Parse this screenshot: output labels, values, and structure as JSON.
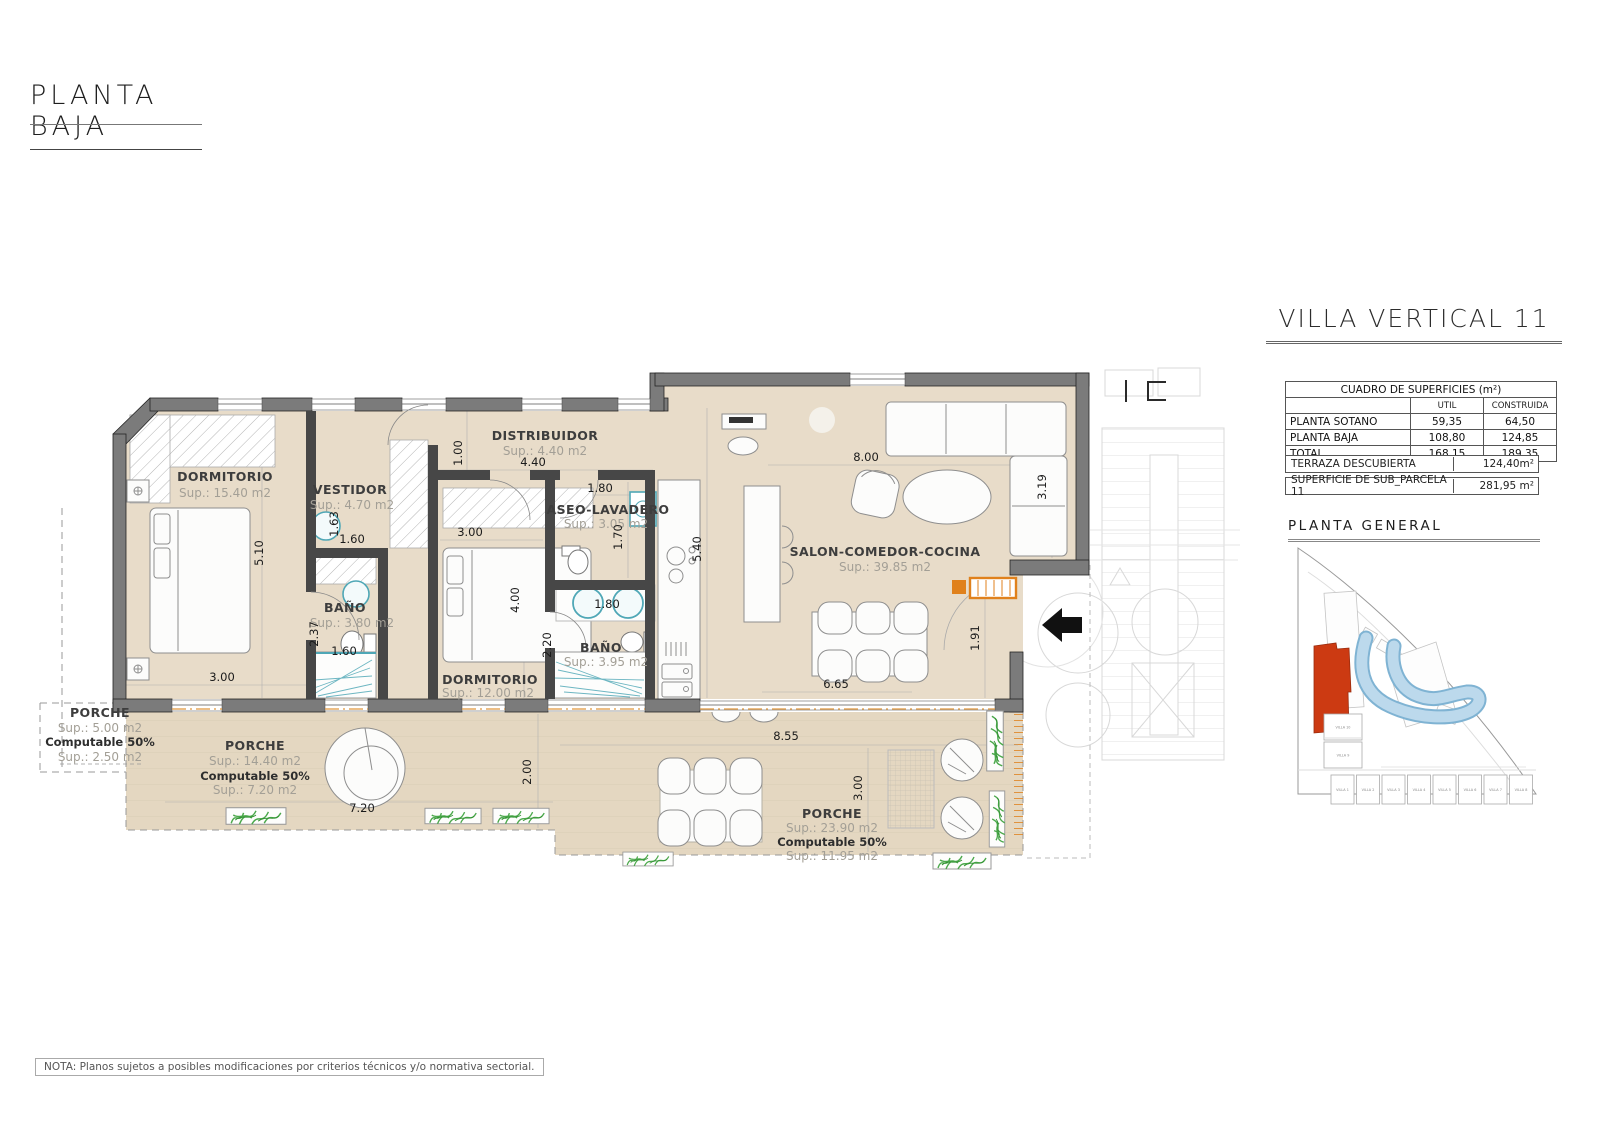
{
  "page": {
    "title": "PLANTA BAJA",
    "note": "NOTA: Planos sujetos a posibles modificaciones por criterios técnicos y/o normativa sectorial."
  },
  "panel": {
    "villa_title": "VILLA VERTICAL 11",
    "table": {
      "title": "CUADRO DE SUPERFICIES (m²)",
      "cols": [
        "UTIL",
        "CONSTRUIDA"
      ],
      "rows": [
        [
          "PLANTA SOTANO",
          "59,35",
          "64,50"
        ],
        [
          "PLANTA BAJA",
          "108,80",
          "124,85"
        ],
        [
          "TOTAL",
          "168,15",
          "189,35"
        ]
      ]
    },
    "terraza_label": "TERRAZA DESCUBIERTA",
    "terraza_value": "124,40m²",
    "parcela_label": "SUPERFICIE DE SUB_PARCELA 11",
    "parcela_value": "281,95 m²",
    "siteplan_title": "PLANTA GENERAL",
    "site_villas_row": [
      "VILLA 1",
      "VILLA 2",
      "VILLA 3",
      "VILLA 4",
      "VILLA 5",
      "VILLA 6",
      "VILLA 7",
      "VILLA 8"
    ],
    "site_villas_left": [
      "VILLA 10",
      "VILLA 9"
    ]
  },
  "floorplan": {
    "rooms": {
      "dormitorio1": {
        "name": "DORMITORIO",
        "sup": "Sup.: 15.40  m2"
      },
      "vestidor": {
        "name": "VESTIDOR",
        "sup": "Sup.: 4.70    m2"
      },
      "bano1": {
        "name": "BAÑO",
        "sup": "Sup.: 3.80    m2"
      },
      "distribuidor": {
        "name": "DISTRIBUIDOR",
        "sup": "Sup.: 4.40    m2"
      },
      "aseo": {
        "name": "ASEO-LAVADERO",
        "sup": "Sup.: 3.05   m2"
      },
      "bano2": {
        "name": "BAÑO",
        "sup": "Sup.: 3.95    m2"
      },
      "dormitorio2": {
        "name": "DORMITORIO",
        "sup": "Sup.: 12.00  m2"
      },
      "salon": {
        "name": "SALON-COMEDOR-COCINA",
        "sup": "Sup.: 39.85 m2"
      },
      "porche_left": {
        "name": "PORCHE",
        "sup": "Sup.: 5.00   m2",
        "computable": "Computable 50%",
        "sup2": "Sup.: 2.50   m2"
      },
      "porche_mid": {
        "name": "PORCHE",
        "sup": "Sup.: 14.40 m2",
        "computable": "Computable 50%",
        "sup2": "Sup.: 7.20   m2"
      },
      "porche_right": {
        "name": "PORCHE",
        "sup": "Sup.: 23.90 m2",
        "computable": "Computable 50%",
        "sup2": "Sup.: 11.95  m2"
      }
    },
    "dims": [
      {
        "t": "5.10",
        "x": 263,
        "y": 553,
        "r": -90
      },
      {
        "t": "3.00",
        "x": 222,
        "y": 681,
        "r": 0
      },
      {
        "t": "1.63",
        "x": 338,
        "y": 524,
        "r": -90
      },
      {
        "t": "1.60",
        "x": 352,
        "y": 543,
        "r": 0
      },
      {
        "t": "2.37",
        "x": 318,
        "y": 634,
        "r": -90
      },
      {
        "t": "1.60",
        "x": 344,
        "y": 655,
        "r": 0
      },
      {
        "t": "1.00",
        "x": 462,
        "y": 453,
        "r": -90
      },
      {
        "t": "4.40",
        "x": 533,
        "y": 466,
        "r": 0
      },
      {
        "t": "3.00",
        "x": 470,
        "y": 536,
        "r": 0
      },
      {
        "t": "1.80",
        "x": 600,
        "y": 492,
        "r": 0
      },
      {
        "t": "1.70",
        "x": 622,
        "y": 537,
        "r": -90
      },
      {
        "t": "4.00",
        "x": 519,
        "y": 600,
        "r": -90
      },
      {
        "t": "1.80",
        "x": 607,
        "y": 608,
        "r": 0
      },
      {
        "t": "2.20",
        "x": 551,
        "y": 645,
        "r": -90
      },
      {
        "t": "5.40",
        "x": 701,
        "y": 549,
        "r": -90
      },
      {
        "t": "8.00",
        "x": 866,
        "y": 461,
        "r": 0
      },
      {
        "t": "3.19",
        "x": 1046,
        "y": 487,
        "r": -90
      },
      {
        "t": "6.65",
        "x": 836,
        "y": 688,
        "r": 0
      },
      {
        "t": "1.91",
        "x": 979,
        "y": 638,
        "r": -90
      },
      {
        "t": "7.20",
        "x": 362,
        "y": 812,
        "r": 0
      },
      {
        "t": "2.00",
        "x": 531,
        "y": 772,
        "r": -90
      },
      {
        "t": "8.55",
        "x": 786,
        "y": 740,
        "r": 0
      },
      {
        "t": "3.00",
        "x": 862,
        "y": 788,
        "r": -90
      }
    ]
  },
  "colors": {
    "wall_gray": "#7b7b7b",
    "partition_gray": "#474747",
    "floor_tan": "#e8dcc9",
    "porch_tan": "#e4d7c1",
    "accent_orange": "#e0811c",
    "accent_teal": "#4fa7b6",
    "highlight_red": "#cc3a12",
    "pool_blue": "#a9cfe6",
    "plant_green": "#4aa84a"
  }
}
